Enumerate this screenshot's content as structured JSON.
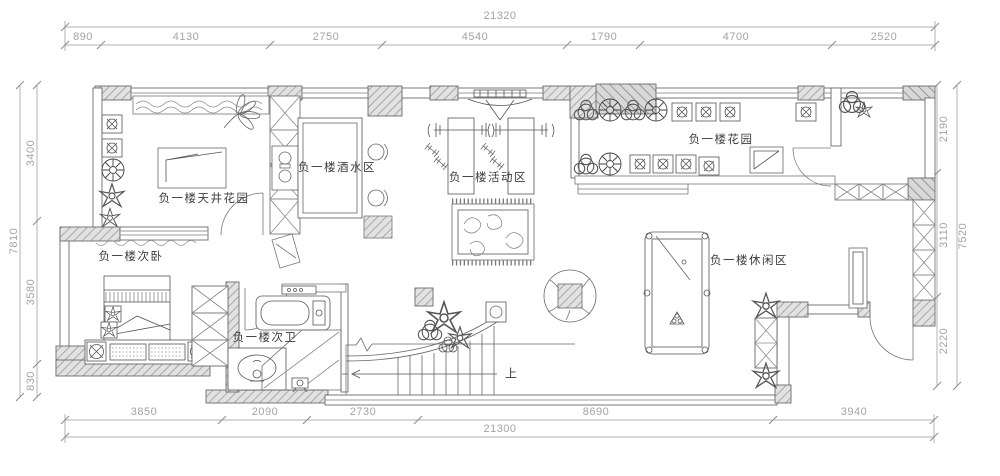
{
  "plan": {
    "rooms": {
      "courtyard_garden": "负一楼天井花园",
      "bar_area": "负一楼酒水区",
      "activity_area": "负一楼活动区",
      "garden": "负一楼花园",
      "second_bedroom": "负一楼次卧",
      "second_bathroom": "负一楼次卫",
      "leisure_area": "负一楼休闲区"
    },
    "stair_direction": "上"
  },
  "dimensions": {
    "top": {
      "overall": "21320",
      "segments": [
        "890",
        "4130",
        "2750",
        "4540",
        "1790",
        "4700",
        "2520"
      ]
    },
    "bottom": {
      "overall": "21300",
      "segments": [
        "3850",
        "2090",
        "2730",
        "8690",
        "3940"
      ]
    },
    "left": {
      "overall": "7810",
      "segments": [
        "3400",
        "3580",
        "830"
      ]
    },
    "right": {
      "overall": "7520",
      "segments": [
        "2190",
        "3110",
        "2220"
      ]
    }
  },
  "colors": {
    "wall_line": "#6b6b6b",
    "hatch": "#8f8f8f",
    "dimension": "#a3a3a3",
    "label": "#3c3c3c",
    "background": "#ffffff"
  }
}
